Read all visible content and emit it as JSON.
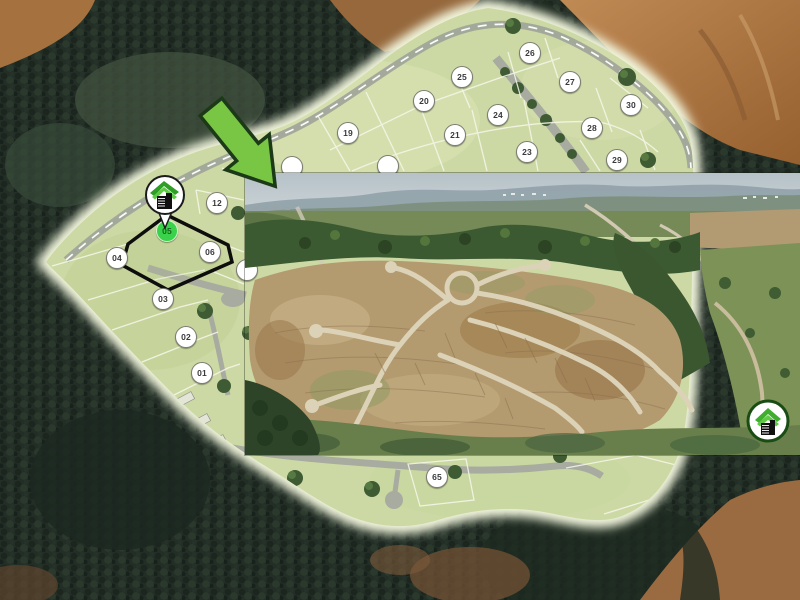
{
  "site_plan": {
    "highlighted_lot_id": "05",
    "lots": [
      {
        "id": "01",
        "x": 202,
        "y": 373
      },
      {
        "id": "02",
        "x": 186,
        "y": 337
      },
      {
        "id": "03",
        "x": 163,
        "y": 299
      },
      {
        "id": "04",
        "x": 117,
        "y": 258
      },
      {
        "id": "05",
        "x": 167,
        "y": 231
      },
      {
        "id": "06",
        "x": 210,
        "y": 252
      },
      {
        "id": "12",
        "x": 217,
        "y": 203
      },
      {
        "id": "19",
        "x": 348,
        "y": 133
      },
      {
        "id": "20",
        "x": 424,
        "y": 101
      },
      {
        "id": "21",
        "x": 455,
        "y": 135
      },
      {
        "id": "23",
        "x": 527,
        "y": 152
      },
      {
        "id": "24",
        "x": 498,
        "y": 115
      },
      {
        "id": "25",
        "x": 462,
        "y": 77
      },
      {
        "id": "26",
        "x": 530,
        "y": 53
      },
      {
        "id": "27",
        "x": 570,
        "y": 82
      },
      {
        "id": "28",
        "x": 592,
        "y": 128
      },
      {
        "id": "29",
        "x": 617,
        "y": 160
      },
      {
        "id": "30",
        "x": 631,
        "y": 105
      },
      {
        "id": "65",
        "x": 437,
        "y": 477
      }
    ],
    "partial_badges": [
      {
        "x": 292,
        "y": 167
      },
      {
        "x": 388,
        "y": 166
      },
      {
        "x": 247,
        "y": 270
      }
    ],
    "colors": {
      "plan_green": "#cdd9a4",
      "fringe": "#eef3d6",
      "badge_bg": "#ffffff",
      "badge_text": "#3a3a3a",
      "highlight_badge_bg": "#3bd24b",
      "highlight_badge_text": "#14661a",
      "highlight_outline": "#0d0d0d",
      "road_grey": "#9fa399"
    }
  },
  "arrow": {
    "icon": "callout-arrow-icon",
    "fill": "#79c544",
    "stroke": "#1c3a17"
  },
  "logos": {
    "pin_icon": "developer-logo-pin-icon",
    "inset_icon": "developer-logo-icon",
    "roof_green": "#3fae2e",
    "ring_green": "#1a4d14"
  }
}
